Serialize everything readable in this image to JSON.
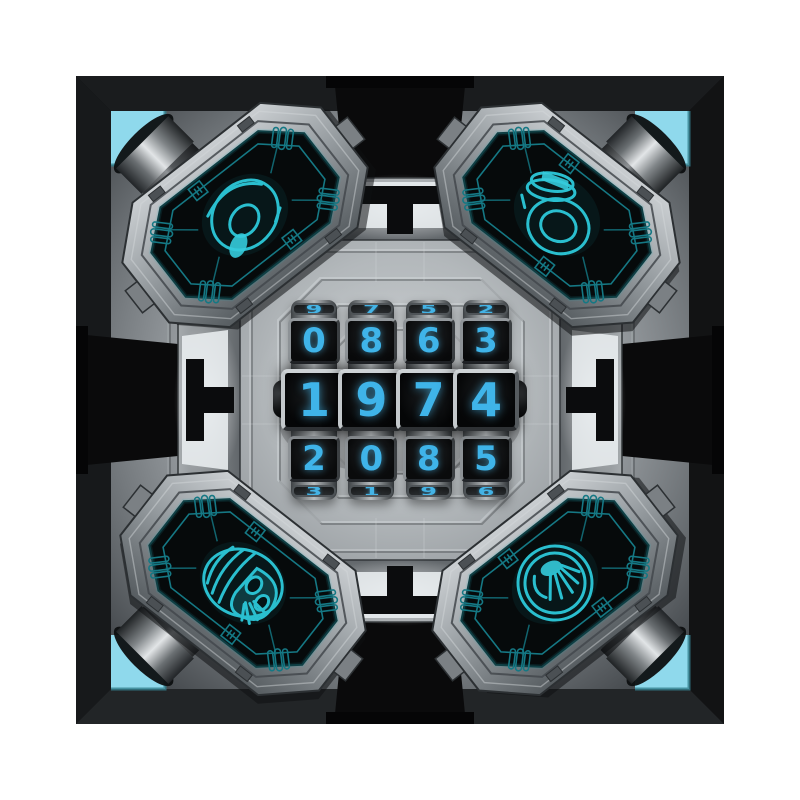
{
  "scene": {
    "name": "sci-fi vault combination lock",
    "code": "1974"
  },
  "lock": {
    "dials": [
      {
        "above": "9",
        "top": "0",
        "middle": "1",
        "bottom": "2",
        "below": "3"
      },
      {
        "above": "7",
        "top": "8",
        "middle": "9",
        "bottom": "0",
        "below": "1"
      },
      {
        "above": "5",
        "top": "6",
        "middle": "7",
        "bottom": "8",
        "below": "9"
      },
      {
        "above": "2",
        "top": "3",
        "middle": "4",
        "bottom": "5",
        "below": "6"
      }
    ]
  },
  "panels": {
    "top_left": {
      "icon": "helmet-icon"
    },
    "top_right": {
      "icon": "jar-icon"
    },
    "bottom_left": {
      "icon": "skull-icon"
    },
    "bottom_right": {
      "icon": "medallion-icon"
    }
  },
  "colors": {
    "digit": "#3fb4e9",
    "wireframe": "#2abfcf",
    "corner_glass": "#8fd9ec",
    "frame": "#0d0d0e"
  }
}
